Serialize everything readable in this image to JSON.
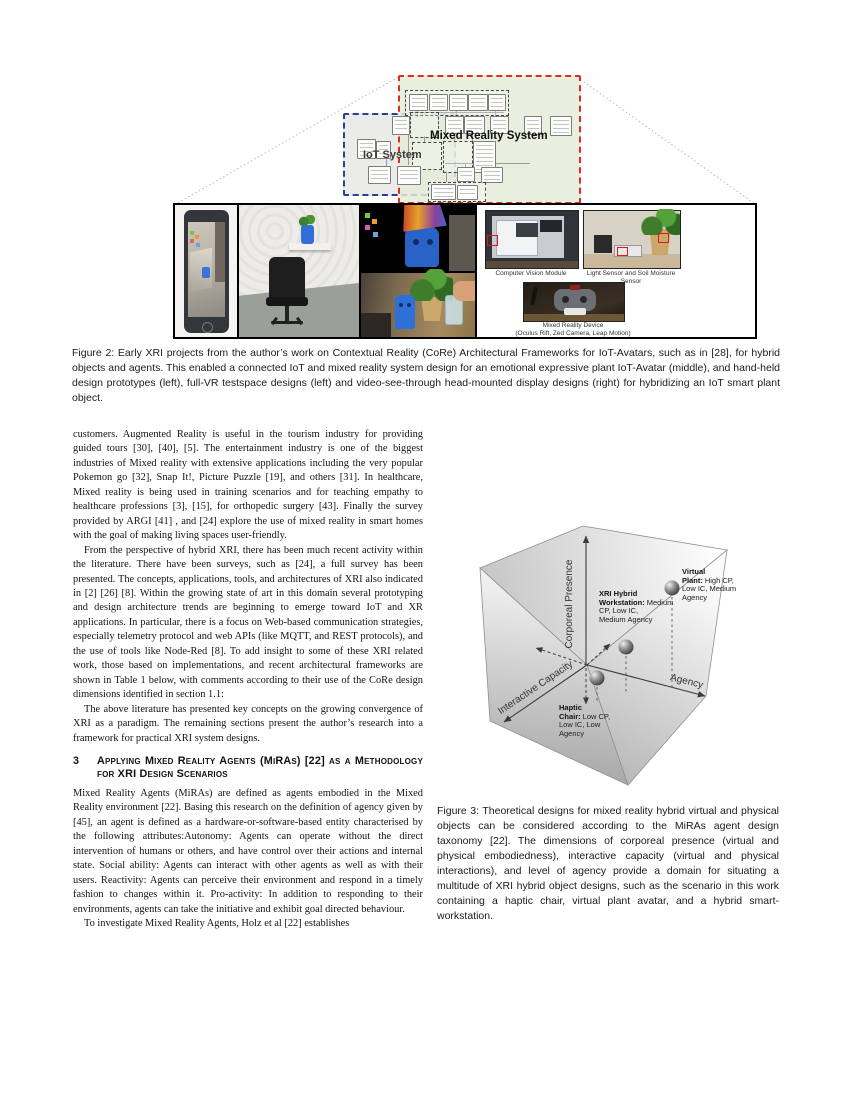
{
  "figure2": {
    "diagram": {
      "mr_label": "Mixed Reality System",
      "iot_label": "IoT System",
      "mr_border_color": "#e02b20",
      "iot_border_color": "#2c3f8e",
      "mr_fill_color": "#e6ecdb",
      "iot_fill_color": "#ebebe9"
    },
    "photo_captions": {
      "cv": "Computer Vision Module",
      "sensors": "Light Sensor and Soil Moisture Sensor",
      "device_line1": "Mixed Reality Device",
      "device_line2": "(Oculus Rift, Zed Camera, Leap Motion)"
    },
    "caption": "Figure 2: Early XRI projects from the author’s work on Contextual Reality (CoRe) Architectural Frameworks for IoT-Avatars, such as in [28], for hybrid objects and agents. This enabled a connected IoT and mixed reality system design for an emotional expressive plant IoT-Avatar (middle), and hand-held design prototypes (left), full-VR testspace designs (left) and video-see-through head-mounted display designs (right) for hybridizing an IoT smart plant object."
  },
  "left_column": {
    "para1": "customers. Augmented Reality is useful in the tourism industry for providing guided tours [30], [40], [5]. The entertainment industry is one of the biggest industries of Mixed reality with extensive applications including the very popular Pokemon go [32], Snap It!, Picture Puzzle [19], and others [31]. In healthcare, Mixed reality is being used in training scenarios and for teaching empathy to healthcare professions [3], [15], for orthopedic surgery [43]. Finally the survey provided by ARGI [41] , and [24] explore the use of mixed reality in smart homes with the goal of making living spaces user-friendly.",
    "para2": "From the perspective of hybrid XRI, there has been much recent activity within the literature. There have been surveys, such as [24], a full survey has been presented. The concepts, applications, tools, and architectures of XRI also indicated in [2] [26] [8]. Within the growing state of art in this domain several prototyping and design architecture trends are beginning to emerge toward IoT and XR applications. In particular, there is a focus on Web-based communication strategies, especially telemetry protocol and web APIs (like MQTT, and REST protocols), and the use of tools like Node-Red [8]. To add insight to some of these XRI related work, those based on implementations, and recent architectural frameworks are shown in Table 1 below, with comments according to their use of the CoRe design dimensions identified in section 1.1:",
    "para3": "The above literature has presented key concepts on the growing convergence of XRI as a paradigm. The remaining sections present the author’s research into a framework for practical XRI system designs.",
    "section3_number": "3",
    "section3_title": "Applying Mixed Reality Agents (MiRAs) [22] as a Methodology for XRI Design Scenarios",
    "para4": "Mixed Reality Agents (MiRAs) are defined as agents embodied in the Mixed Reality environment [22]. Basing this research on the definition of agency given by [45], an agent is defined as a hardware-or-software-based entity characterised by the following attributes:Autonomy: Agents can operate without the direct intervention of humans or others, and have control over their actions and internal state. Social ability: Agents can interact with other agents as well as with their users. Reactivity: Agents can perceive their environment and respond in a timely fashion to changes within it. Pro-activity: In addition to responding to their environments, agents can take the initiative and exhibit goal directed behaviour.",
    "para5": "To investigate Mixed Reality Agents, Holz et al [22] establishes"
  },
  "figure3": {
    "axes": {
      "vertical": "Corporeal Presence",
      "left": "Interactive Capacity",
      "right": "Agency"
    },
    "points": [
      {
        "name": "Virtual Plant:",
        "desc": "High CP, Low IC, Medium Agency"
      },
      {
        "name": "XRI Hybrid Workstation:",
        "desc": "Medium CP, Low IC, Medium Agency"
      },
      {
        "name": "Haptic Chair:",
        "desc": "Low CP, Low IC, Low Agency"
      }
    ],
    "caption": "Figure 3: Theoretical designs for mixed reality hybrid virtual and physical objects can be considered according to the MiRAs agent design taxonomy [22]. The dimensions of corporeal presence (virtual and physical embodiedness), interactive capacity (virtual and physical interactions), and level of agency provide a domain for situating a multitude of XRI hybrid object designs, such as the scenario in this work containing a haptic chair, virtual plant avatar, and a hybrid smart-workstation."
  }
}
